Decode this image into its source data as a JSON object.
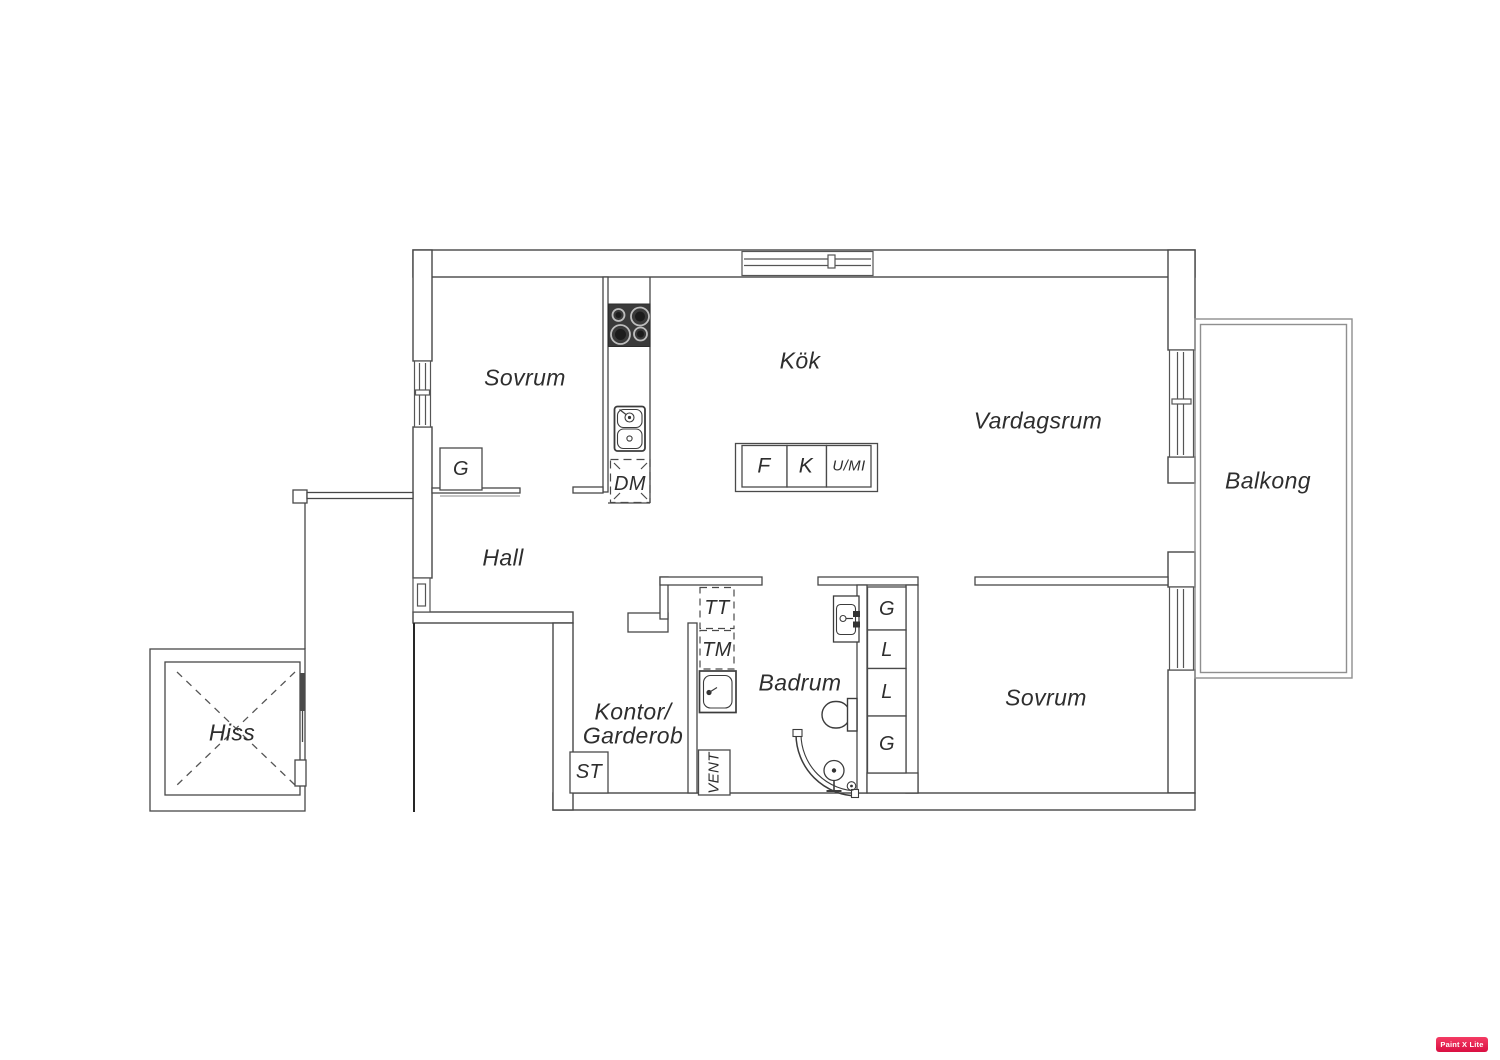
{
  "colors": {
    "wall": "#474747",
    "light_wall": "#8f8f8f",
    "text": "#2e2e2e",
    "stove": "#3a3a3a",
    "watermark_bg": "#d90f42"
  },
  "rooms": {
    "bedroom_top": "Sovrum",
    "kitchen": "Kök",
    "living_room": "Vardagsrum",
    "balcony": "Balkong",
    "hall": "Hall",
    "office_wardrobe": [
      "Kontor/",
      "Garderob"
    ],
    "bathroom": "Badrum",
    "bedroom_right": "Sovrum",
    "elevator": "Hiss"
  },
  "labels": {
    "hall_closet": "G",
    "dishwasher": "DM",
    "fridge": "F",
    "freezer": "K",
    "oven_micro": "U/MI",
    "tumble_dryer": "TT",
    "washing_machine": "TM",
    "cleaning_closet": "ST",
    "vent": "VENT",
    "closet_stack": [
      "G",
      "L",
      "L",
      "G"
    ]
  },
  "watermark": "Paint X Lite"
}
